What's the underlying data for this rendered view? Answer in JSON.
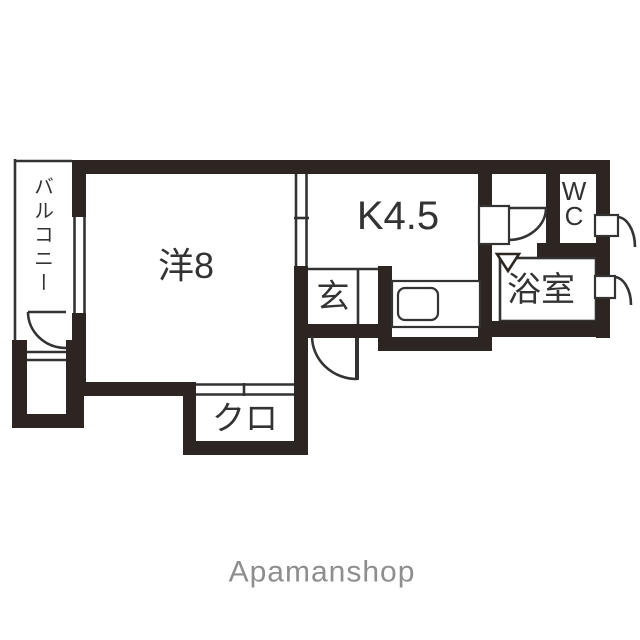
{
  "floorplan": {
    "rooms": {
      "balcony": "バルコニー",
      "western_room": "洋8",
      "kitchen": "K4.5",
      "entrance": "玄",
      "closet": "クロ",
      "wc_line1": "W",
      "wc_line2": "C",
      "bathroom": "浴室"
    },
    "branding": {
      "logo": "Apamanshop"
    },
    "colors": {
      "wall": "#2d2521",
      "line": "#333333",
      "background": "#ffffff",
      "logo_text": "#8e8e8e"
    }
  }
}
